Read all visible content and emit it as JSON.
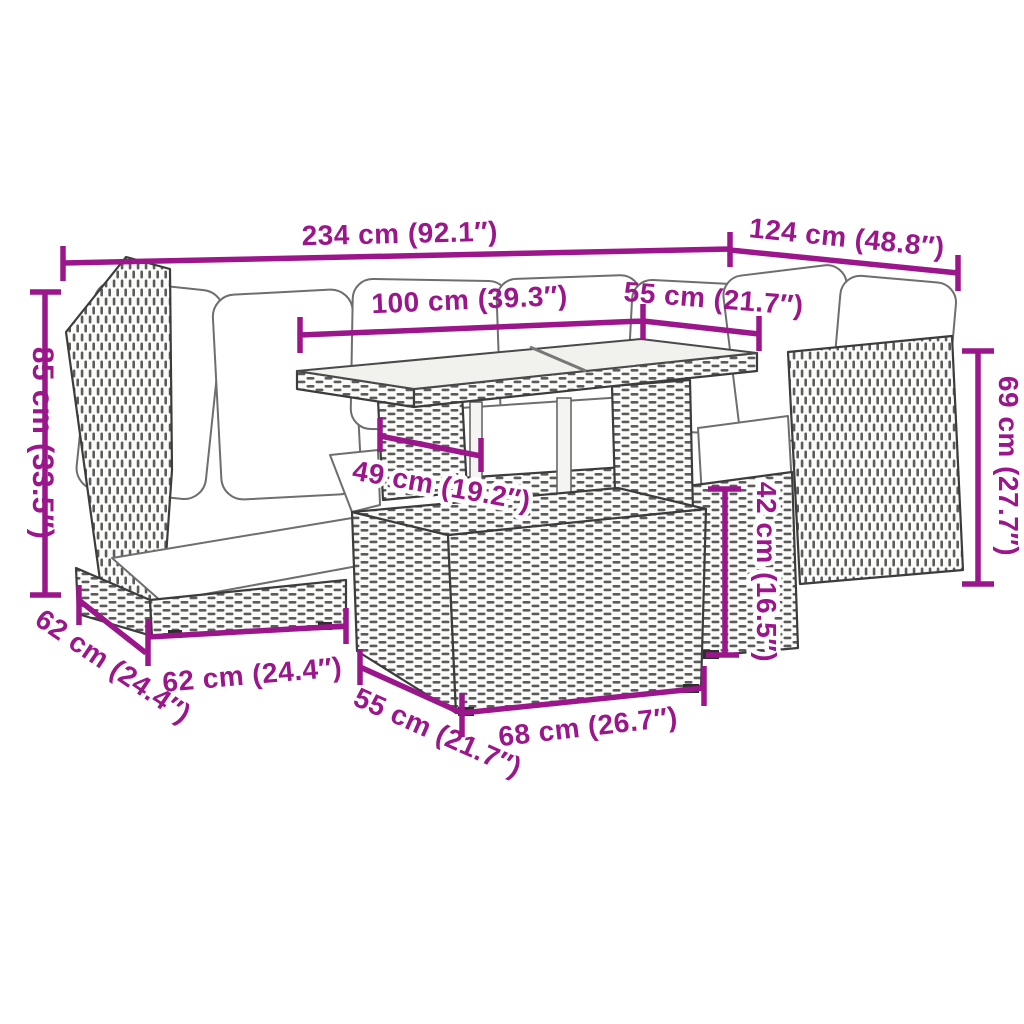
{
  "page": {
    "title": "Garden furniture set dimension diagram"
  },
  "colors": {
    "accent": "#9A168A",
    "outline": "#3C3C3C",
    "weave": "#383838",
    "cushion": "#FFFFFF",
    "glass": "#F1F1ED",
    "background": "#FFFFFF"
  },
  "dimensions": {
    "overall_width": "234 cm (92.1″)",
    "right_section_width": "124 cm (48.8″)",
    "table_length": "100 cm (39.3″)",
    "table_width": "55 cm (21.7″)",
    "backrest_height": "85 cm (33.5″)",
    "right_backrest_height": "69 cm (27.7″)",
    "table_base_width": "49 cm (19.2″)",
    "seat_height": "42 cm (16.5″)",
    "seat_depth": "62 cm (24.4″)",
    "seat_width": "62 cm (24.4″)",
    "ottoman_depth": "55 cm (21.7″)",
    "ottoman_width": "68 cm (26.7″)"
  }
}
